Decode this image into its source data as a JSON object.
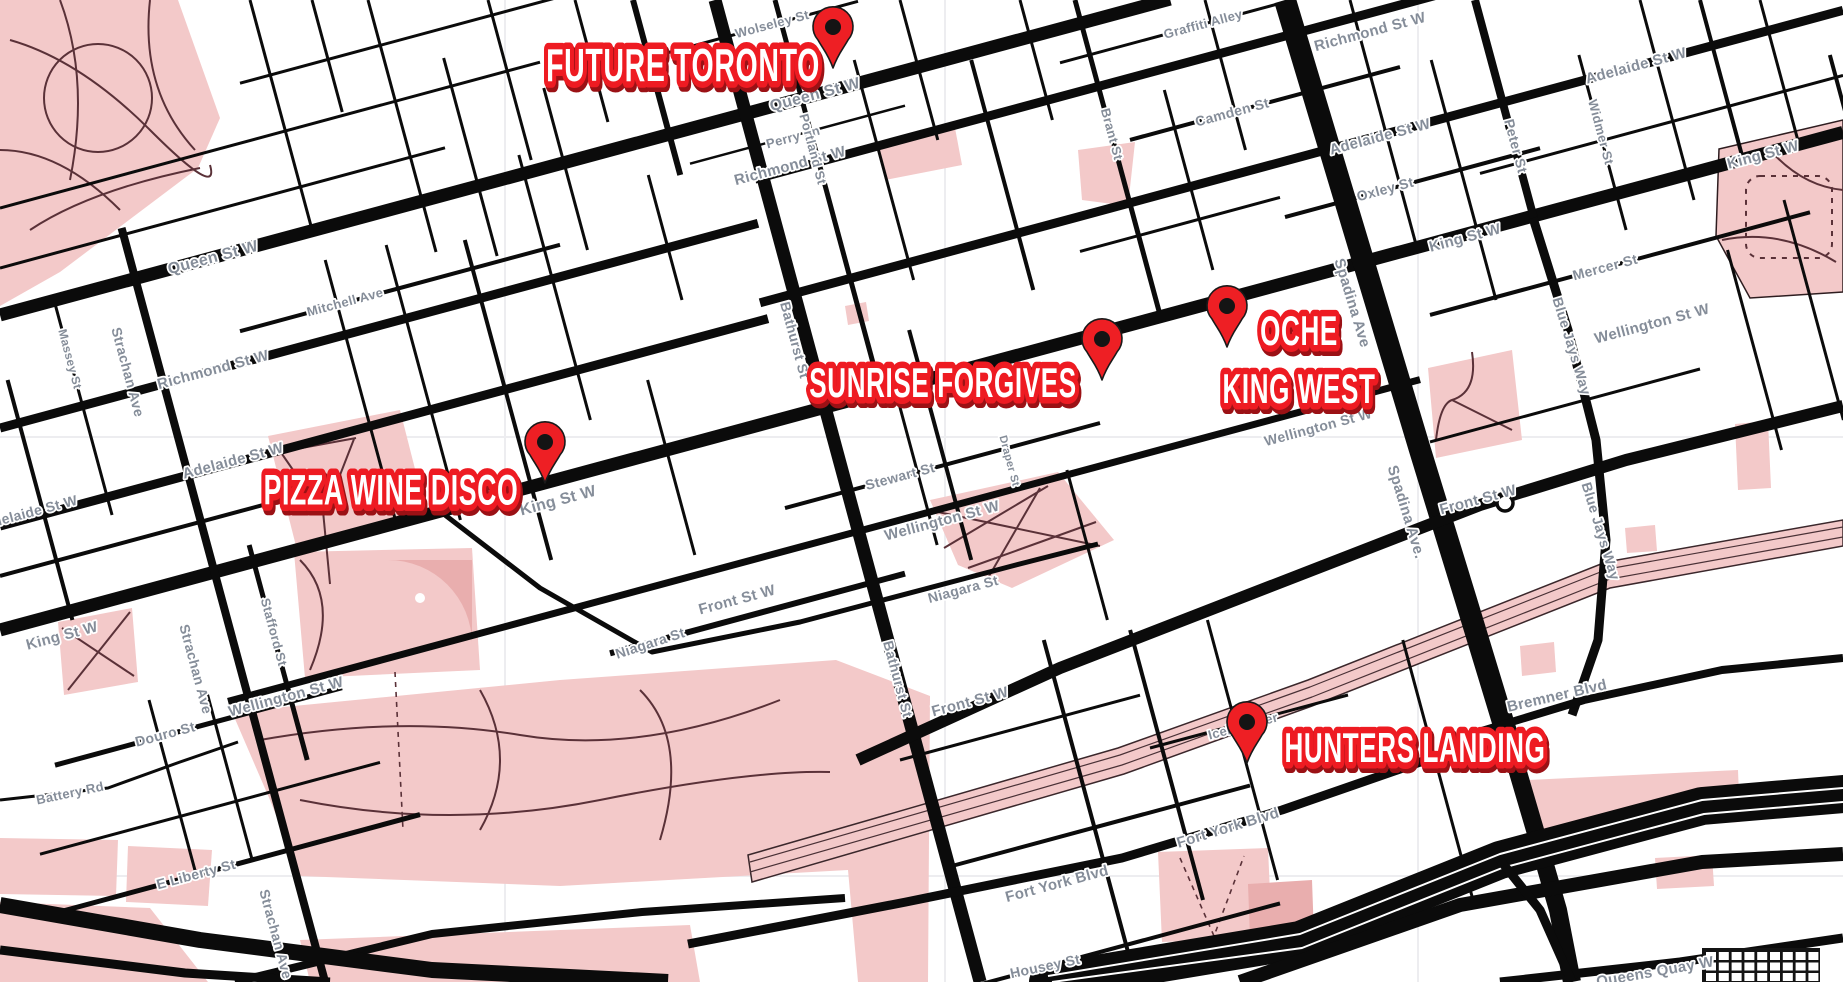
{
  "map": {
    "colors": {
      "background": "#ffffff",
      "road_black": "#0b0b0b",
      "park_pink": "#f3c9c9",
      "park_pink_dark": "#e9aeae",
      "park_path": "#5a3138",
      "street_label_gray": "#858d99",
      "venue_red": "#ee1b22",
      "venue_red_dark": "#9b1115",
      "pin_red": "#ee1f24",
      "pin_dot_black": "#141414",
      "grid_faint": "#ededf0"
    },
    "venues": [
      {
        "id": "future-toronto",
        "name": "FUTURE TORONTO",
        "lines": [
          "FUTURE TORONTO"
        ],
        "label_x": 683,
        "label_y": 66,
        "line_height": 58,
        "font_size": 46,
        "pin_x": 833,
        "pin_y": 68
      },
      {
        "id": "sunrise-forgives",
        "name": "SUNRISE FORGIVES",
        "lines": [
          "SUNRISE FORGIVES"
        ],
        "label_x": 943,
        "label_y": 383,
        "line_height": 58,
        "font_size": 42,
        "pin_x": 1102,
        "pin_y": 380
      },
      {
        "id": "oche-king-west",
        "name": "OCHE KING WEST",
        "lines": [
          "OCHE",
          "KING WEST"
        ],
        "label_x": 1299,
        "label_y": 331,
        "line_height": 58,
        "font_size": 42,
        "pin_x": 1227,
        "pin_y": 347
      },
      {
        "id": "pizza-wine-disco",
        "name": "PIZZA WINE DISCO",
        "lines": [
          "PIZZA WINE DISCO"
        ],
        "label_x": 391,
        "label_y": 490,
        "line_height": 58,
        "font_size": 43,
        "pin_x": 545,
        "pin_y": 483
      },
      {
        "id": "hunters-landing",
        "name": "HUNTERS LANDING",
        "lines": [
          "HUNTERS LANDING"
        ],
        "label_x": 1415,
        "label_y": 748,
        "line_height": 58,
        "font_size": 42,
        "pin_x": 1247,
        "pin_y": 763
      }
    ],
    "street_labels": [
      {
        "name": "Queen St W",
        "x": 815,
        "y": 95,
        "rot": -15,
        "size": 16
      },
      {
        "name": "Queen St W",
        "x": 213,
        "y": 258,
        "rot": -15,
        "size": 16
      },
      {
        "name": "Richmond St W",
        "x": 790,
        "y": 166,
        "rot": -15,
        "size": 15
      },
      {
        "name": "Richmond St W",
        "x": 1370,
        "y": 32,
        "rot": -15,
        "size": 15
      },
      {
        "name": "Richmond St W",
        "x": 213,
        "y": 370,
        "rot": -15,
        "size": 15
      },
      {
        "name": "Adelaide St W",
        "x": 1380,
        "y": 137,
        "rot": -15,
        "size": 15
      },
      {
        "name": "Adelaide St W",
        "x": 233,
        "y": 461,
        "rot": -15,
        "size": 15
      },
      {
        "name": "Adelaide St W",
        "x": 1636,
        "y": 66,
        "rot": -15,
        "size": 15
      },
      {
        "name": "Adelaide St W",
        "x": 30,
        "y": 512,
        "rot": -15,
        "size": 14
      },
      {
        "name": "King St W",
        "x": 1763,
        "y": 155,
        "rot": -15,
        "size": 15
      },
      {
        "name": "King St W",
        "x": 1465,
        "y": 238,
        "rot": -15,
        "size": 15
      },
      {
        "name": "King St W",
        "x": 558,
        "y": 501,
        "rot": -15,
        "size": 16
      },
      {
        "name": "King St W",
        "x": 62,
        "y": 636,
        "rot": -15,
        "size": 15
      },
      {
        "name": "Wellington St W",
        "x": 942,
        "y": 521,
        "rot": -15,
        "size": 15
      },
      {
        "name": "Wellington St W",
        "x": 286,
        "y": 697,
        "rot": -15,
        "size": 15
      },
      {
        "name": "Wellington St W",
        "x": 1652,
        "y": 324,
        "rot": -15,
        "size": 15
      },
      {
        "name": "Wellington St W",
        "x": 1318,
        "y": 427,
        "rot": -15,
        "size": 14
      },
      {
        "name": "Front St W",
        "x": 970,
        "y": 702,
        "rot": -15,
        "size": 15
      },
      {
        "name": "Front St W",
        "x": 1478,
        "y": 500,
        "rot": -15,
        "size": 15
      },
      {
        "name": "Front St W",
        "x": 737,
        "y": 600,
        "rot": -15,
        "size": 15
      },
      {
        "name": "Fort York Blvd",
        "x": 1228,
        "y": 828,
        "rot": -17,
        "size": 15
      },
      {
        "name": "Fort York Blvd",
        "x": 1057,
        "y": 884,
        "rot": -15,
        "size": 15
      },
      {
        "name": "Bremner Blvd",
        "x": 1557,
        "y": 696,
        "rot": -13,
        "size": 15
      },
      {
        "name": "Queens Quay W",
        "x": 1655,
        "y": 972,
        "rot": -10,
        "size": 15
      },
      {
        "name": "Housey St",
        "x": 1045,
        "y": 966,
        "rot": -12,
        "size": 14
      },
      {
        "name": "Iceboat Ter",
        "x": 1243,
        "y": 726,
        "rot": -15,
        "size": 13
      },
      {
        "name": "Mercer St",
        "x": 1605,
        "y": 267,
        "rot": -15,
        "size": 14
      },
      {
        "name": "Stewart St",
        "x": 900,
        "y": 476,
        "rot": -15,
        "size": 14
      },
      {
        "name": "Niagara St",
        "x": 963,
        "y": 589,
        "rot": -15,
        "size": 14
      },
      {
        "name": "Niagara St",
        "x": 650,
        "y": 643,
        "rot": -18,
        "size": 14
      },
      {
        "name": "Mitchell Ave",
        "x": 345,
        "y": 302,
        "rot": -15,
        "size": 13
      },
      {
        "name": "Douro St",
        "x": 165,
        "y": 734,
        "rot": -15,
        "size": 14
      },
      {
        "name": "E Liberty St",
        "x": 196,
        "y": 874,
        "rot": -15,
        "size": 14
      },
      {
        "name": "Battery Rd",
        "x": 70,
        "y": 793,
        "rot": -12,
        "size": 13
      },
      {
        "name": "Camden St",
        "x": 1232,
        "y": 112,
        "rot": -15,
        "size": 14
      },
      {
        "name": "Oxley St",
        "x": 1385,
        "y": 189,
        "rot": -15,
        "size": 14
      },
      {
        "name": "Graffiti Alley",
        "x": 1203,
        "y": 24,
        "rot": -15,
        "size": 13
      },
      {
        "name": "Perry Ln",
        "x": 793,
        "y": 137,
        "rot": -15,
        "size": 13
      },
      {
        "name": "Wolseley St",
        "x": 772,
        "y": 24,
        "rot": -15,
        "size": 13
      },
      {
        "name": "Strachan Ave",
        "x": 128,
        "y": 372,
        "rot": 75,
        "size": 14
      },
      {
        "name": "Strachan Ave",
        "x": 196,
        "y": 669,
        "rot": 75,
        "size": 14
      },
      {
        "name": "Strachan Ave",
        "x": 276,
        "y": 934,
        "rot": 75,
        "size": 14
      },
      {
        "name": "Bathurst St",
        "x": 795,
        "y": 340,
        "rot": 75,
        "size": 14
      },
      {
        "name": "Bathurst St",
        "x": 898,
        "y": 679,
        "rot": 75,
        "size": 14
      },
      {
        "name": "Spadina Ave",
        "x": 1352,
        "y": 303,
        "rot": 73,
        "size": 15
      },
      {
        "name": "Spadina Ave.",
        "x": 1406,
        "y": 512,
        "rot": 73,
        "size": 15
      },
      {
        "name": "Portland St",
        "x": 813,
        "y": 149,
        "rot": 75,
        "size": 13
      },
      {
        "name": "Brant St",
        "x": 1112,
        "y": 134,
        "rot": 75,
        "size": 13
      },
      {
        "name": "Peter St",
        "x": 1516,
        "y": 146,
        "rot": 75,
        "size": 14
      },
      {
        "name": "Widmer St",
        "x": 1601,
        "y": 132,
        "rot": 75,
        "size": 13
      },
      {
        "name": "Blue Jays Way",
        "x": 1572,
        "y": 346,
        "rot": 73,
        "size": 14
      },
      {
        "name": "Blue Jays Way",
        "x": 1601,
        "y": 531,
        "rot": 73,
        "size": 14
      },
      {
        "name": "Massey St",
        "x": 70,
        "y": 359,
        "rot": 75,
        "size": 12
      },
      {
        "name": "Stafford St",
        "x": 274,
        "y": 632,
        "rot": 75,
        "size": 13
      },
      {
        "name": "Draper St",
        "x": 1009,
        "y": 461,
        "rot": 75,
        "size": 11
      }
    ]
  }
}
